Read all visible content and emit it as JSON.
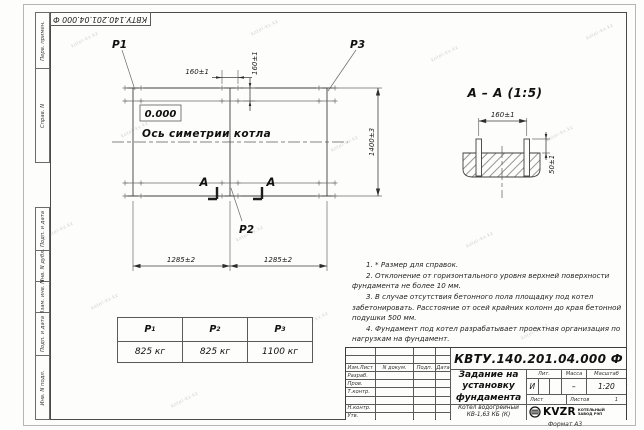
{
  "watermark": {
    "text": "kotel-kv.kz"
  },
  "stamp_top": {
    "doc_number": "КВТУ.140.201.04.000 Ф"
  },
  "side_column": {
    "labels": [
      "Перв. примен.",
      "Справ. N",
      "Подп. и дата",
      "Инв. N дубл.",
      "Взам. инв. N",
      "Подп. и дата",
      "Инв. N подл."
    ]
  },
  "plan": {
    "labels": {
      "p1": "P1",
      "p2": "P2",
      "p3": "P3",
      "elevation": "0.000",
      "axis": "Ось симетрии котла",
      "section_letter": "А"
    },
    "dims": {
      "bolt_x": "160±1",
      "bolt_y": "160±1",
      "left_span": "1285±2",
      "right_span": "1285±2",
      "depth": "1400±3"
    }
  },
  "section": {
    "title": "А – А (1:5)",
    "dims": {
      "spacing": "160±1",
      "height": "50±1"
    }
  },
  "notes": {
    "items": [
      "1. * Размер для справок.",
      "2. Отклонение от горизонтального уровня верхней поверхности фундамента не более 10 мм.",
      "3. В случае отсутствия бетонного пола площадку под котел забетонировать. Расстояние от осей крайних колонн до края бетонной подушки 500 мм.",
      "4. Фундамент под котел разрабатывает проектная организация по нагрузкам на фундамент."
    ]
  },
  "load_table": {
    "columns": [
      {
        "symbol": "P",
        "sub": "1",
        "value": "825 кг"
      },
      {
        "symbol": "P",
        "sub": "2",
        "value": "825 кг"
      },
      {
        "symbol": "P",
        "sub": "3",
        "value": "1100 кг"
      }
    ]
  },
  "title_block": {
    "doc_number": "КВТУ.140.201.04.000 Ф",
    "title_line1": "Задание на",
    "title_line2": "установку",
    "title_line3": "фундамента",
    "product_line1": "Котел водогрейный",
    "product_line2": "КВ-1,63 КБ (К)",
    "rev_cols": {
      "izm": "Изм.Лист",
      "doc": "N докум.",
      "sign": "Подп.",
      "date": "Дата"
    },
    "roles": {
      "dev": "Разраб.",
      "check": "Пров.",
      "tcontr": "Т.контр.",
      "ncontr": "Н.контр.",
      "approve": "Утв."
    },
    "lit_label": "Лит.",
    "mass_label": "Масса",
    "scale_label": "Масштаб",
    "lit_value": "И",
    "mass_value": "–",
    "scale_value": "1:20",
    "sheet_label": "Лист",
    "sheets_label": "Листов",
    "sheets_value": "1",
    "logo": {
      "name": "KVZR",
      "caption1": "КОТЕЛЬНЫЙ",
      "caption2": "ЗАВОД РЭП"
    }
  },
  "footer": {
    "format_label": "Формат А3"
  }
}
